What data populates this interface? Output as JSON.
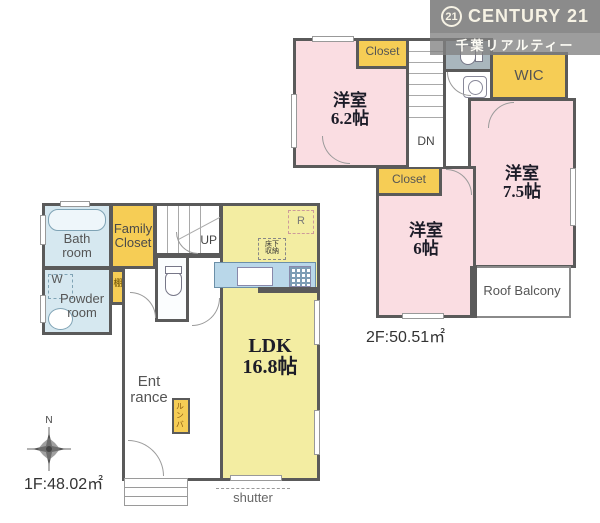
{
  "colors": {
    "wall": "#5a5a5a",
    "room_pink": "#fadde2",
    "room_yellow": "#f3eda2",
    "closet_gold": "#f6cd55",
    "water_blue": "#d6e8f0",
    "counter_blue": "#b9d7e9",
    "toilet_gray": "#a9b6bd",
    "banner_gray": "#8b8b8b"
  },
  "header": {
    "logo_circle": "21",
    "logo_text": "CENTURY 21",
    "company": "千葉リアルティー"
  },
  "floor2": {
    "area_label": "2F:50.51㎡",
    "bedroom62_name": "洋室",
    "bedroom62_size": "6.2帖",
    "bedroom75_name": "洋室",
    "bedroom75_size": "7.5帖",
    "bedroom6_name": "洋室",
    "bedroom6_size": "6帖",
    "closet_top": "Closet",
    "closet_mid": "Closet",
    "wic": "WIC",
    "roof_balcony": "Roof Balcony",
    "stairs_down": "DN"
  },
  "floor1": {
    "area_label": "1F:48.02㎡",
    "bath_line1": "Bath",
    "bath_line2": "room",
    "family_closet_line1": "Family",
    "family_closet_line2": "Closet",
    "powder_w": "W",
    "powder_line1": "Powder",
    "powder_line2": "room",
    "shelf": "棚",
    "entrance_line1": "Ent",
    "entrance_line2": "rance",
    "roomba": "ルンバ",
    "ldk_name": "LDK",
    "ldk_size": "16.8帖",
    "stairs_up": "UP",
    "fridge": "R",
    "underfloor_line1": "床下",
    "underfloor_line2": "収納",
    "shutter": "shutter",
    "compass_north": "N"
  }
}
